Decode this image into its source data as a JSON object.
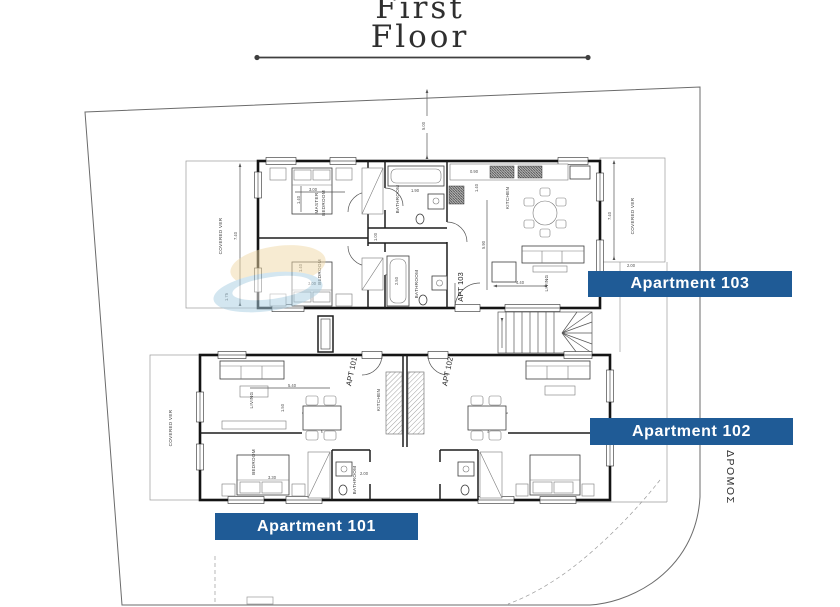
{
  "colors": {
    "accent_blue": "#1f5b96",
    "line_dark": "#141414",
    "line_light": "#9a9a9a",
    "watermark_blue": "#a9cfe3",
    "watermark_yellow": "#f0d9a6"
  },
  "title": {
    "line1": "First",
    "line2": "Floor"
  },
  "road_label": "ΔΡΟΜΟΣ",
  "apartment_boxes": {
    "apt103": "Apartment 103",
    "apt102": "Apartment 102",
    "apt101": "Apartment 101"
  },
  "upper_floorplan": {
    "apt_tag": "APT 103",
    "covered_veranda_left": "COVERED VER",
    "covered_veranda_right": "COVERED VER",
    "master_bedroom_line1": "MASTER",
    "master_bedroom_line2": "BEDROOM",
    "bedroom": "BEDROOM",
    "bathroom_top": "BATHROOM",
    "bathroom_bottom": "BATHROOM",
    "kitchen": "KITCHEN",
    "living": "LIVING",
    "dims": {
      "setback": "5.00",
      "veranda_left_depth": "7.40",
      "veranda_left_width": "1.75",
      "veranda_right_depth": "7.40",
      "veranda_right_width": "2.00",
      "master_width": "3.00",
      "master_bed": "1.40",
      "bedroom_width": "3.00",
      "bedroom_bed": "1.40",
      "bath_top": "1.90",
      "bath_bottom": "2.50",
      "hall": "1.00",
      "kitchen_front": "0.90",
      "kitchen_depth": "1.40",
      "living_depth": "5.90",
      "living_width": "4.40"
    }
  },
  "lower_floorplan": {
    "apt101_tag": "APT 101",
    "apt102_tag": "APT 102",
    "covered_veranda": "COVERED VER",
    "living": "LIVING",
    "bedroom": "BEDROOM",
    "kitchen": "KITCHEN",
    "bathroom": "BATHROOM",
    "dims": {
      "living_width": "5.40",
      "living_depth": "1.50",
      "bedroom_width": "3.30",
      "bathroom_width": "2.00"
    }
  }
}
